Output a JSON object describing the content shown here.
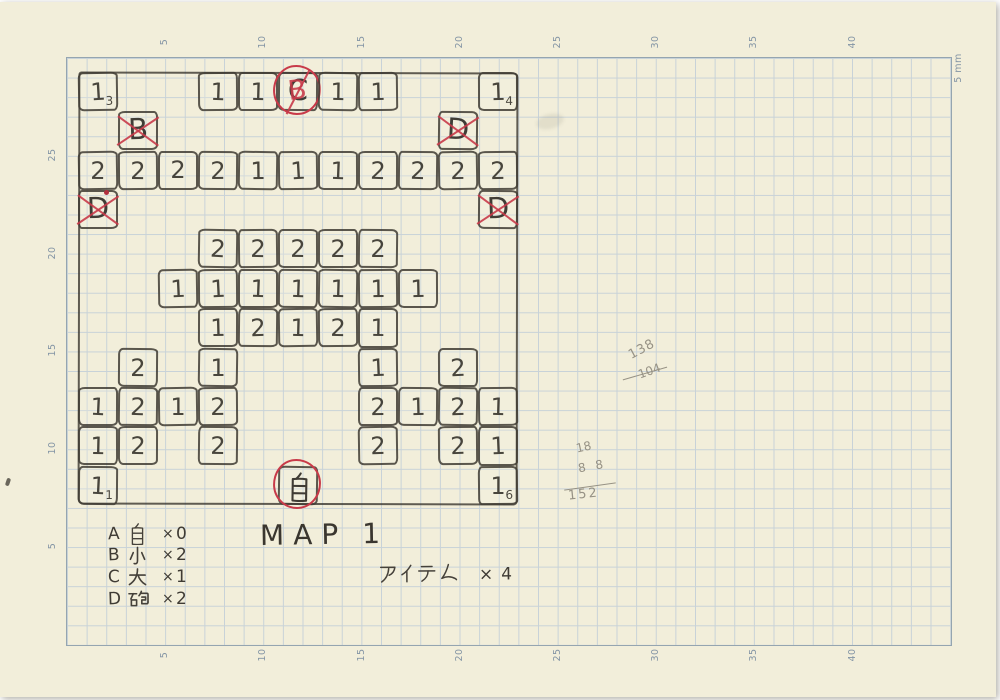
{
  "ruler": {
    "top": [
      "5",
      "10",
      "15",
      "20",
      "25",
      "30",
      "35",
      "40"
    ],
    "bottom": [
      "5",
      "10",
      "15",
      "20",
      "25",
      "30",
      "35",
      "40"
    ],
    "left": [
      "25",
      "20",
      "15",
      "10",
      "5"
    ],
    "unit": "5 mm"
  },
  "map": {
    "rows": 11,
    "cols": 11,
    "cells": [
      {
        "r": 0,
        "c": 0,
        "v": "1",
        "sub": "3"
      },
      {
        "r": 0,
        "c": 3,
        "v": "1"
      },
      {
        "r": 0,
        "c": 4,
        "v": "1"
      },
      {
        "r": 0,
        "c": 5,
        "v": "C",
        "circle": true,
        "overlay": "B",
        "slash": true
      },
      {
        "r": 0,
        "c": 6,
        "v": "1"
      },
      {
        "r": 0,
        "c": 7,
        "v": "1"
      },
      {
        "r": 0,
        "c": 10,
        "v": "1",
        "sub": "4"
      },
      {
        "r": 1,
        "c": 1,
        "v": "B",
        "cross": true
      },
      {
        "r": 1,
        "c": 9,
        "v": "D",
        "cross": true
      },
      {
        "r": 2,
        "c": 0,
        "v": "2"
      },
      {
        "r": 2,
        "c": 1,
        "v": "2"
      },
      {
        "r": 2,
        "c": 2,
        "v": "2"
      },
      {
        "r": 2,
        "c": 3,
        "v": "2"
      },
      {
        "r": 2,
        "c": 4,
        "v": "1"
      },
      {
        "r": 2,
        "c": 5,
        "v": "1"
      },
      {
        "r": 2,
        "c": 6,
        "v": "1"
      },
      {
        "r": 2,
        "c": 7,
        "v": "2"
      },
      {
        "r": 2,
        "c": 8,
        "v": "2"
      },
      {
        "r": 2,
        "c": 9,
        "v": "2"
      },
      {
        "r": 2,
        "c": 10,
        "v": "2"
      },
      {
        "r": 3,
        "c": 0,
        "v": "D",
        "cross": true,
        "dot": true
      },
      {
        "r": 3,
        "c": 10,
        "v": "D",
        "cross": true
      },
      {
        "r": 4,
        "c": 3,
        "v": "2"
      },
      {
        "r": 4,
        "c": 4,
        "v": "2"
      },
      {
        "r": 4,
        "c": 5,
        "v": "2"
      },
      {
        "r": 4,
        "c": 6,
        "v": "2"
      },
      {
        "r": 4,
        "c": 7,
        "v": "2"
      },
      {
        "r": 5,
        "c": 2,
        "v": "1"
      },
      {
        "r": 5,
        "c": 3,
        "v": "1"
      },
      {
        "r": 5,
        "c": 4,
        "v": "1"
      },
      {
        "r": 5,
        "c": 5,
        "v": "1"
      },
      {
        "r": 5,
        "c": 6,
        "v": "1"
      },
      {
        "r": 5,
        "c": 7,
        "v": "1"
      },
      {
        "r": 5,
        "c": 8,
        "v": "1"
      },
      {
        "r": 6,
        "c": 3,
        "v": "1"
      },
      {
        "r": 6,
        "c": 4,
        "v": "2"
      },
      {
        "r": 6,
        "c": 5,
        "v": "1"
      },
      {
        "r": 6,
        "c": 6,
        "v": "2"
      },
      {
        "r": 6,
        "c": 7,
        "v": "1"
      },
      {
        "r": 7,
        "c": 1,
        "v": "2"
      },
      {
        "r": 7,
        "c": 3,
        "v": "1"
      },
      {
        "r": 7,
        "c": 7,
        "v": "1"
      },
      {
        "r": 7,
        "c": 9,
        "v": "2"
      },
      {
        "r": 8,
        "c": 0,
        "v": "1"
      },
      {
        "r": 8,
        "c": 1,
        "v": "2"
      },
      {
        "r": 8,
        "c": 2,
        "v": "1"
      },
      {
        "r": 8,
        "c": 3,
        "v": "2"
      },
      {
        "r": 8,
        "c": 7,
        "v": "2"
      },
      {
        "r": 8,
        "c": 8,
        "v": "1"
      },
      {
        "r": 8,
        "c": 9,
        "v": "2"
      },
      {
        "r": 8,
        "c": 10,
        "v": "1"
      },
      {
        "r": 9,
        "c": 0,
        "v": "1"
      },
      {
        "r": 9,
        "c": 1,
        "v": "2"
      },
      {
        "r": 9,
        "c": 3,
        "v": "2"
      },
      {
        "r": 9,
        "c": 7,
        "v": "2"
      },
      {
        "r": 9,
        "c": 9,
        "v": "2"
      },
      {
        "r": 9,
        "c": 10,
        "v": "1"
      },
      {
        "r": 10,
        "c": 0,
        "v": "1",
        "sub": "1"
      },
      {
        "r": 10,
        "c": 5,
        "v": "自",
        "circle": true
      },
      {
        "r": 10,
        "c": 10,
        "v": "1",
        "sub": "6"
      }
    ]
  },
  "legend": {
    "times": "×",
    "items": [
      {
        "letter": "A",
        "kanji": "自",
        "count": "0"
      },
      {
        "letter": "B",
        "kanji": "小",
        "count": "2"
      },
      {
        "letter": "C",
        "kanji": "大",
        "count": "1"
      },
      {
        "letter": "D",
        "kanji": "砲",
        "count": "2"
      }
    ]
  },
  "map_title": {
    "word": "MAP",
    "number": "1"
  },
  "items_note": {
    "label": "アイテム",
    "times": "×",
    "count": "4"
  },
  "scribbles": {
    "s1": [
      "138",
      "104"
    ],
    "s2": [
      "18",
      "8 8",
      "152"
    ]
  },
  "colors": {
    "paper": "#f2eeda",
    "grid_line": "#c8d2d8",
    "grid_border": "#95a5b0",
    "pencil": "#3f3b34",
    "red_pen": "#c83a49"
  }
}
